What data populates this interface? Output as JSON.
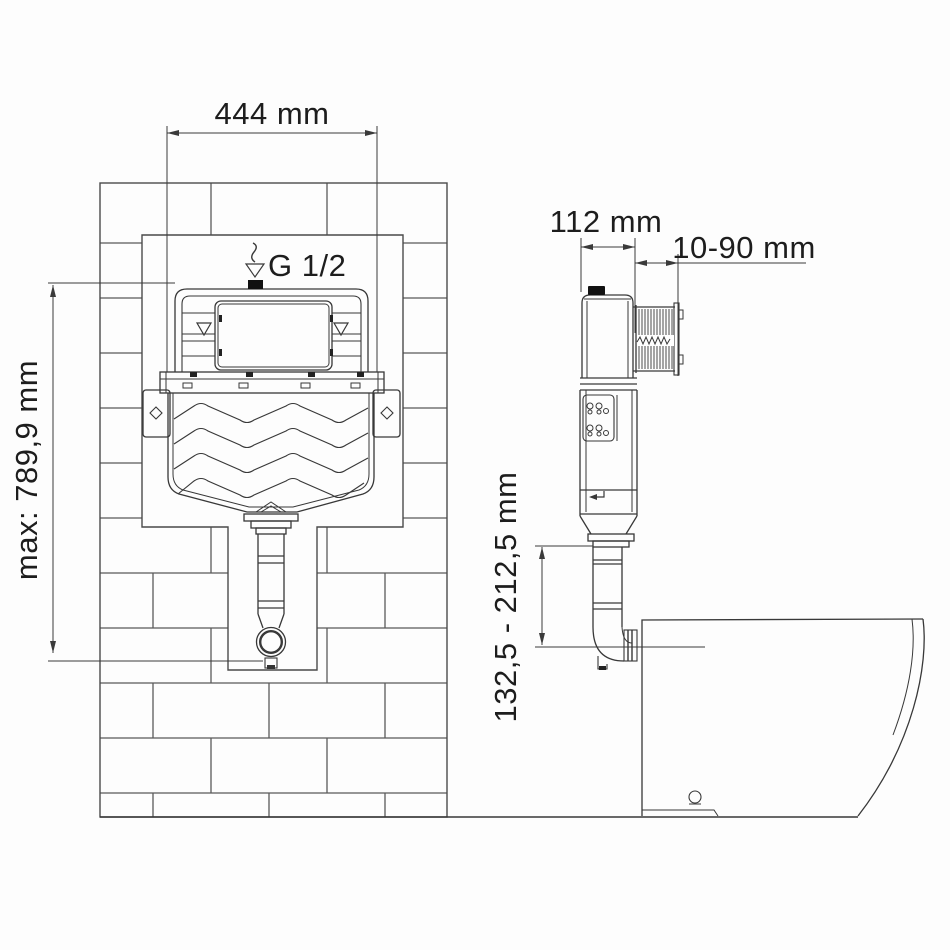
{
  "title": "concealed-cistern-installation-diagram",
  "front_view": {
    "width_label": "444 mm",
    "max_height_label": "max: 789,9 mm",
    "inlet_thread_label": "G 1/2"
  },
  "side_view": {
    "depth_label": "112 mm",
    "wall_thickness_range_label": "10-90 mm",
    "flush_pipe_height_range_label": "132,5 - 212,5 mm"
  },
  "colors": {
    "outline": "#383838",
    "brick_line": "#5a5a5a",
    "dimension_line": "#3a3a3a",
    "label_text": "#1d1d1d",
    "background": "#fdfdfd"
  }
}
